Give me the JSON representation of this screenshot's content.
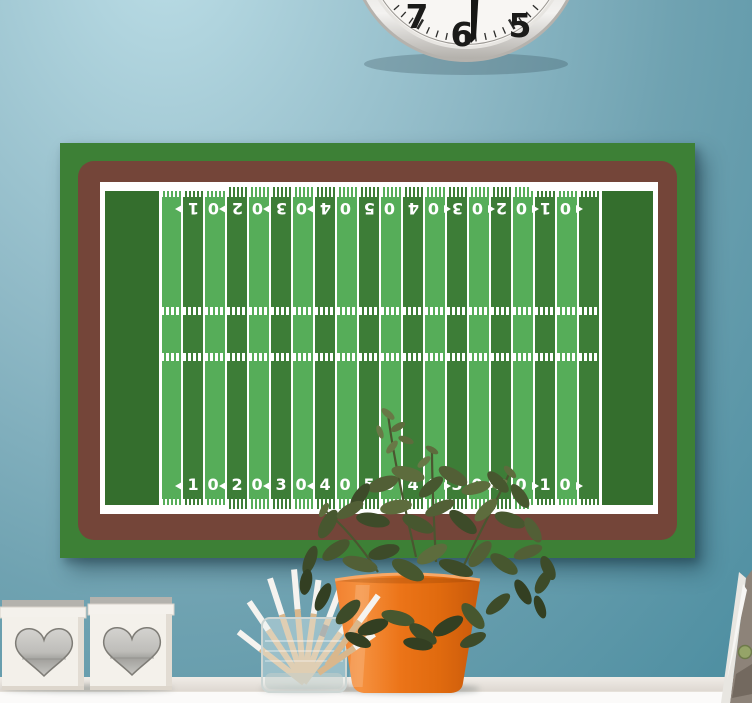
{
  "wall": {
    "top_color": "#bbdde6",
    "mid_color": "#8fb9c6",
    "bottom_color": "#4b8da0"
  },
  "clock": {
    "numerals": [
      "7",
      "6",
      "5"
    ],
    "face_color": "#f8f6f3",
    "rim_color": "#c9c6c2"
  },
  "poster": {
    "colors": {
      "outer_green": "#3d8036",
      "border_brown": "#744539",
      "endzone_green": "#346e2d",
      "stripe_dark": "#3d7d37",
      "stripe_light": "#56ad59",
      "line_white": "#ffffff"
    },
    "field": {
      "yard_numbers": [
        "10",
        "20",
        "30",
        "40",
        "50",
        "40",
        "30",
        "20",
        "10"
      ],
      "arrows": [
        "left",
        "left",
        "left",
        "left",
        "none",
        "right",
        "right",
        "right",
        "right"
      ]
    }
  },
  "shelf": {
    "surface_color": "#ece8e2",
    "front_color": "#fbfaf9"
  },
  "decor": {
    "pot_color": "#ea7315",
    "pencil_wood_color": "#d9b78c",
    "pencil_tip_color": "#f5f3ef",
    "heart_box_color": "#f3f0ea",
    "heart_inlay_color": "#b0afab",
    "plant_leaf_colors": [
      "#333f22",
      "#3d4b29",
      "#47572f",
      "#525f36",
      "#5d6c3d",
      "#687846"
    ]
  }
}
